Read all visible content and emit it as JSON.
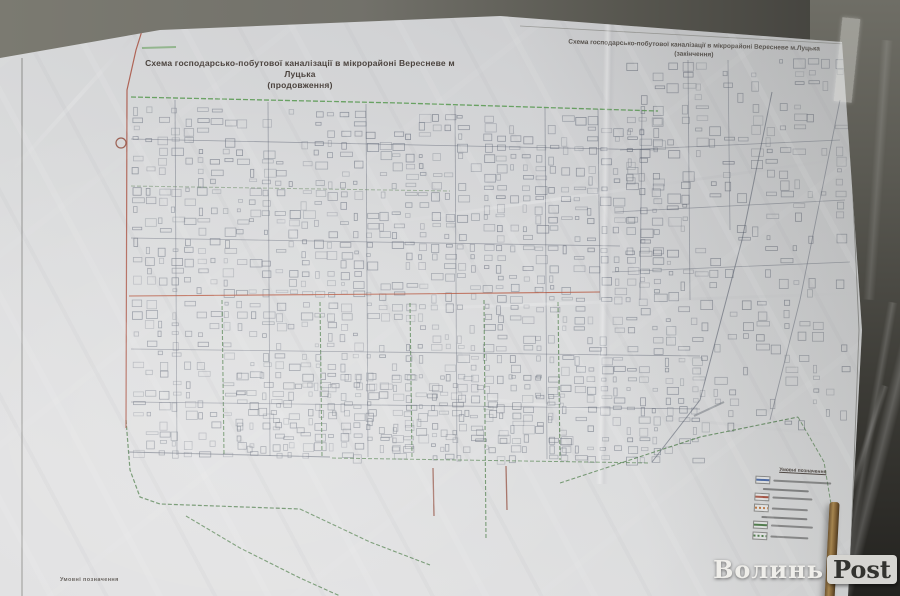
{
  "poster": {
    "left_sheet": {
      "title_line1": "Схема господарсько-побутової каналізації в мікрорайоні Вересневе м Луцька",
      "title_line2": "(продовження)"
    },
    "right_sheet": {
      "title_line1": "Схема господарсько-побутової каналізації в мікрорайоні Вересневе м.Луцька",
      "title_line2": "(закінчення)"
    },
    "corner_label": "Умовні позначення",
    "legend": {
      "title": "Умовні позначення",
      "items": [
        {
          "kind": "row",
          "swatch": "#4a6aa8",
          "dash": false,
          "text_w": 58
        },
        {
          "kind": "sub"
        },
        {
          "kind": "row",
          "swatch": "#a8503f",
          "dash": false,
          "text_w": 40
        },
        {
          "kind": "row",
          "swatch": "#c07840",
          "dash": true,
          "text_w": 36
        },
        {
          "kind": "sub"
        },
        {
          "kind": "row",
          "swatch": "#4e7d4a",
          "dash": false,
          "text_w": 42
        },
        {
          "kind": "row",
          "swatch": "#4e7d4a",
          "dash": true,
          "text_w": 38
        }
      ]
    }
  },
  "watermark": {
    "text_plain": "Волинь",
    "text_boxed": "Post"
  },
  "map": {
    "seed": 7,
    "colors": {
      "street": "#59606f",
      "sewer_green": "#4e7d4a",
      "main_red": "#a8503f",
      "paper": "#d6d7d9"
    },
    "features": [
      {
        "name": "frame-left",
        "color": "#6b6b66",
        "w": 0.9,
        "op": 0.75,
        "pts": [
          [
            22,
            58
          ],
          [
            22,
            596
          ]
        ]
      },
      {
        "name": "frame-right",
        "color": "#6b6b66",
        "w": 0.9,
        "op": 0.7,
        "pts": [
          [
            846,
            44
          ],
          [
            859,
            330
          ],
          [
            849,
            596
          ]
        ]
      },
      {
        "name": "frame-top-right",
        "color": "#77776f",
        "w": 0.8,
        "op": 0.6,
        "pts": [
          [
            520,
            26
          ],
          [
            845,
            44
          ]
        ]
      },
      {
        "name": "sewer-top",
        "color": "#55984e",
        "w": 1.3,
        "op": 0.85,
        "dash": "5 2",
        "pts": [
          [
            131,
            97
          ],
          [
            400,
            103
          ],
          [
            658,
            111
          ]
        ]
      },
      {
        "name": "sewer-h2",
        "color": "#6f8f6a",
        "w": 1.0,
        "op": 0.6,
        "dash": "4 2",
        "pts": [
          [
            131,
            186
          ],
          [
            450,
            191
          ]
        ]
      },
      {
        "name": "sewer-v1",
        "color": "#4e7d4a",
        "w": 1.1,
        "op": 0.8,
        "dash": "4 2",
        "pts": [
          [
            222,
            300
          ],
          [
            224,
            455
          ]
        ]
      },
      {
        "name": "sewer-v2",
        "color": "#4e7d4a",
        "w": 1.1,
        "op": 0.8,
        "dash": "4 2",
        "pts": [
          [
            320,
            302
          ],
          [
            322,
            457
          ]
        ]
      },
      {
        "name": "sewer-v3",
        "color": "#4e7d4a",
        "w": 1.1,
        "op": 0.8,
        "dash": "4 2",
        "pts": [
          [
            410,
            303
          ],
          [
            412,
            458
          ]
        ]
      },
      {
        "name": "sewer-v4",
        "color": "#4e7d4a",
        "w": 1.1,
        "op": 0.8,
        "dash": "4 2",
        "pts": [
          [
            484,
            300
          ],
          [
            486,
            540
          ]
        ]
      },
      {
        "name": "sewer-v5",
        "color": "#4e7d4a",
        "w": 1.1,
        "op": 0.8,
        "dash": "4 2",
        "pts": [
          [
            558,
            302
          ],
          [
            560,
            460
          ]
        ]
      },
      {
        "name": "sewer-left-curve",
        "color": "#4e7d4a",
        "w": 1.2,
        "op": 0.85,
        "dash": "4 2",
        "pts": [
          [
            126,
            420
          ],
          [
            130,
            470
          ],
          [
            140,
            497
          ],
          [
            160,
            504
          ],
          [
            300,
            509
          ]
        ]
      },
      {
        "name": "sewer-branch-sw",
        "color": "#4e7d4a",
        "w": 1.1,
        "op": 0.8,
        "dash": "4 2",
        "pts": [
          [
            186,
            516
          ],
          [
            240,
            548
          ],
          [
            300,
            578
          ],
          [
            340,
            596
          ]
        ]
      },
      {
        "name": "sewer-diag-se",
        "color": "#4e7d4a",
        "w": 1.1,
        "op": 0.8,
        "dash": "4 2",
        "pts": [
          [
            300,
            509
          ],
          [
            370,
            542
          ],
          [
            430,
            565
          ]
        ]
      },
      {
        "name": "sewer-bottom",
        "color": "#51804d",
        "w": 1.0,
        "op": 0.75,
        "dash": "4 2",
        "pts": [
          [
            332,
            458
          ],
          [
            650,
            463
          ]
        ]
      },
      {
        "name": "sewer-diag-right",
        "color": "#4e7d4a",
        "w": 1.1,
        "op": 0.8,
        "dash": "4 2",
        "pts": [
          [
            560,
            483
          ],
          [
            700,
            437
          ],
          [
            798,
            417
          ]
        ]
      },
      {
        "name": "sewer-right-curve",
        "color": "#4e7d4a",
        "w": 1.0,
        "op": 0.7,
        "dash": "4 2",
        "pts": [
          [
            798,
            417
          ],
          [
            824,
            462
          ],
          [
            833,
            516
          ]
        ]
      },
      {
        "name": "red-main-vertical",
        "color": "#a8503f",
        "w": 1.2,
        "op": 0.85,
        "pts": [
          [
            151,
            2
          ],
          [
            136,
            50
          ],
          [
            127,
            90
          ],
          [
            126,
            428
          ]
        ]
      },
      {
        "name": "red-main-horizontal",
        "color": "#b5543b",
        "w": 1.1,
        "op": 0.85,
        "pts": [
          [
            129,
            296
          ],
          [
            400,
            294
          ],
          [
            600,
            292
          ]
        ]
      },
      {
        "name": "red-stub-1",
        "color": "#8f4a3a",
        "w": 1.3,
        "op": 0.8,
        "pts": [
          [
            433,
            468
          ],
          [
            434,
            516
          ]
        ]
      },
      {
        "name": "red-stub-2",
        "color": "#8f4a3a",
        "w": 1.3,
        "op": 0.8,
        "pts": [
          [
            506,
            466
          ],
          [
            507,
            510
          ]
        ]
      },
      {
        "name": "street-v-175",
        "color": "#59606f",
        "w": 0.8,
        "op": 0.5,
        "pts": [
          [
            175,
            100
          ],
          [
            177,
            455
          ]
        ]
      },
      {
        "name": "street-v-268",
        "color": "#59606f",
        "w": 0.8,
        "op": 0.5,
        "pts": [
          [
            268,
            102
          ],
          [
            270,
            456
          ]
        ]
      },
      {
        "name": "street-v-366",
        "color": "#59606f",
        "w": 0.8,
        "op": 0.5,
        "pts": [
          [
            366,
            104
          ],
          [
            368,
            457
          ]
        ]
      },
      {
        "name": "street-v-455",
        "color": "#59606f",
        "w": 0.8,
        "op": 0.5,
        "pts": [
          [
            455,
            106
          ],
          [
            457,
            458
          ]
        ]
      },
      {
        "name": "street-v-545",
        "color": "#59606f",
        "w": 0.8,
        "op": 0.5,
        "pts": [
          [
            545,
            108
          ],
          [
            547,
            459
          ]
        ]
      },
      {
        "name": "street-v-598",
        "color": "#59606f",
        "w": 0.8,
        "op": 0.5,
        "pts": [
          [
            598,
            109
          ],
          [
            600,
            300
          ]
        ]
      },
      {
        "name": "street-v-642",
        "color": "#59606f",
        "w": 0.8,
        "op": 0.5,
        "pts": [
          [
            642,
            110
          ],
          [
            640,
            300
          ]
        ]
      },
      {
        "name": "street-h-140",
        "color": "#59606f",
        "w": 0.8,
        "op": 0.5,
        "pts": [
          [
            131,
            139
          ],
          [
            658,
            150
          ]
        ]
      },
      {
        "name": "street-h-240",
        "color": "#59606f",
        "w": 0.8,
        "op": 0.5,
        "pts": [
          [
            131,
            238
          ],
          [
            620,
            246
          ]
        ]
      },
      {
        "name": "street-h-350",
        "color": "#59606f",
        "w": 0.8,
        "op": 0.5,
        "pts": [
          [
            131,
            349
          ],
          [
            700,
            356
          ]
        ]
      },
      {
        "name": "street-h-404",
        "color": "#59606f",
        "w": 0.8,
        "op": 0.5,
        "pts": [
          [
            131,
            402
          ],
          [
            700,
            409
          ]
        ]
      },
      {
        "name": "street-h-455",
        "color": "#5a6170",
        "w": 1.0,
        "op": 0.6,
        "pts": [
          [
            128,
            452
          ],
          [
            330,
            457
          ]
        ]
      },
      {
        "name": "street-diag-right",
        "color": "#565d6c",
        "w": 1.0,
        "op": 0.6,
        "pts": [
          [
            772,
            92
          ],
          [
            742,
            240
          ],
          [
            700,
            400
          ],
          [
            652,
            462
          ]
        ]
      },
      {
        "name": "street-v-690",
        "color": "#59606f",
        "w": 0.8,
        "op": 0.5,
        "pts": [
          [
            688,
            60
          ],
          [
            690,
            300
          ]
        ]
      },
      {
        "name": "street-v-730",
        "color": "#59606f",
        "w": 0.8,
        "op": 0.45,
        "pts": [
          [
            728,
            60
          ],
          [
            730,
            230
          ]
        ]
      },
      {
        "name": "street-h-right-150",
        "color": "#59606f",
        "w": 0.8,
        "op": 0.45,
        "pts": [
          [
            620,
            150
          ],
          [
            840,
            140
          ]
        ]
      },
      {
        "name": "street-h-right-210",
        "color": "#59606f",
        "w": 0.8,
        "op": 0.45,
        "pts": [
          [
            615,
            212
          ],
          [
            845,
            200
          ]
        ]
      },
      {
        "name": "street-h-right-270",
        "color": "#59606f",
        "w": 0.8,
        "op": 0.45,
        "pts": [
          [
            612,
            272
          ],
          [
            850,
            262
          ]
        ]
      },
      {
        "name": "road-far-right",
        "color": "#59606f",
        "w": 0.9,
        "op": 0.5,
        "pts": [
          [
            840,
            100
          ],
          [
            800,
            300
          ],
          [
            770,
            420
          ]
        ]
      },
      {
        "name": "street-label-smudge-top",
        "color": "#67a05e",
        "w": 2,
        "op": 0.6,
        "pts": [
          [
            142,
            48
          ],
          [
            176,
            47
          ]
        ]
      },
      {
        "name": "street-label-smudge-right",
        "color": "#6a7078",
        "w": 2,
        "op": 0.5,
        "pts": [
          [
            694,
            416
          ],
          [
            724,
            402
          ]
        ]
      },
      {
        "name": "pump-station-symbol",
        "type": "circle",
        "color": "#8f4a3a",
        "w": 1.2,
        "op": 0.85,
        "cx": 121,
        "cy": 143,
        "r": 5
      }
    ],
    "block_regions": [
      {
        "x": 132,
        "y": 106,
        "w": 525,
        "h": 182,
        "cell": 13,
        "cellh": 10,
        "density": 0.62,
        "slope": 0.022,
        "color": "#525a6b"
      },
      {
        "x": 132,
        "y": 300,
        "w": 560,
        "h": 152,
        "cell": 13,
        "cellh": 10,
        "density": 0.55,
        "slope": 0.012,
        "color": "#525a6b"
      },
      {
        "x": 625,
        "y": 62,
        "w": 215,
        "h": 235,
        "cell": 14,
        "cellh": 11,
        "density": 0.42,
        "slope": -0.02,
        "color": "#555c6b"
      },
      {
        "x": 700,
        "y": 300,
        "w": 150,
        "h": 130,
        "cell": 14,
        "cellh": 11,
        "density": 0.3,
        "slope": -0.01,
        "color": "#555c6b"
      },
      {
        "x": 235,
        "y": 372,
        "w": 330,
        "h": 80,
        "cell": 12,
        "cellh": 9,
        "density": 0.5,
        "slope": 0.01,
        "color": "#4f5766"
      }
    ]
  }
}
